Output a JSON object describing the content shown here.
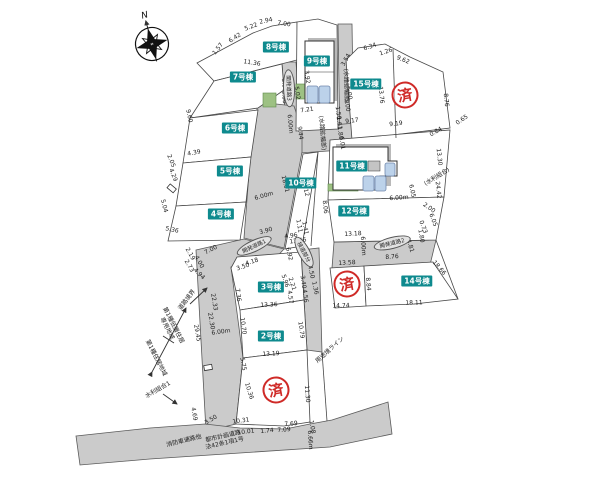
{
  "compass": {
    "label": "N"
  },
  "stamp_text": "済",
  "colors": {
    "badge": "#0e8a8e",
    "stamp": "#cf2a27",
    "road": "#cbcbcb",
    "parking": "#bcd2ea",
    "green": "#9dc183"
  },
  "badges": [
    {
      "t": "2号棟",
      "x": 271,
      "y": 336
    },
    {
      "t": "3号棟",
      "x": 271,
      "y": 287
    },
    {
      "t": "4号棟",
      "x": 221,
      "y": 214
    },
    {
      "t": "5号棟",
      "x": 230,
      "y": 171
    },
    {
      "t": "6号棟",
      "x": 235,
      "y": 128
    },
    {
      "t": "7号棟",
      "x": 243,
      "y": 77
    },
    {
      "t": "8号棟",
      "x": 276,
      "y": 47
    },
    {
      "t": "9号棟",
      "x": 317,
      "y": 61
    },
    {
      "t": "10号棟",
      "x": 301,
      "y": 183
    },
    {
      "t": "11号棟",
      "x": 352,
      "y": 166
    },
    {
      "t": "12号棟",
      "x": 354,
      "y": 211
    },
    {
      "t": "14号棟",
      "x": 417,
      "y": 281
    },
    {
      "t": "15号棟",
      "x": 366,
      "y": 84
    }
  ],
  "stamps": [
    {
      "x": 405,
      "y": 95
    },
    {
      "x": 347,
      "y": 284
    },
    {
      "x": 276,
      "y": 390
    }
  ],
  "ovals": [
    {
      "t": "開発道路3",
      "x": 289,
      "y": 88,
      "r": 88
    },
    {
      "t": "開発道路1",
      "x": 254,
      "y": 246,
      "r": -25
    },
    {
      "t": "接道部分",
      "x": 304,
      "y": 252,
      "r": 62
    },
    {
      "t": "開発道路2",
      "x": 392,
      "y": 243,
      "r": -14
    }
  ],
  "notes": [
    {
      "t": "(水路拡幅部)",
      "x": 346,
      "y": 86,
      "r": 88
    },
    {
      "t": "(水路拡幅部)",
      "x": 322,
      "y": 133,
      "r": 85
    },
    {
      "t": "用途境ライン",
      "x": 330,
      "y": 350,
      "r": -42
    },
    {
      "t": "道路境界",
      "x": 187,
      "y": 300,
      "r": -52
    },
    {
      "t": "第1種低層住居\n専用地域",
      "x": 170,
      "y": 327,
      "r": 63
    },
    {
      "t": "第1種住居地域",
      "x": 156,
      "y": 358,
      "r": 63
    },
    {
      "t": "水利組合1",
      "x": 158,
      "y": 390,
      "r": -30
    },
    {
      "t": "(水利組合)",
      "x": 437,
      "y": 177,
      "r": -32
    },
    {
      "t": "都市計画道路\n法42条1項1号",
      "x": 224,
      "y": 440,
      "r": -13
    },
    {
      "t": "消防車通路他",
      "x": 184,
      "y": 441,
      "r": -14
    }
  ],
  "dims": [
    {
      "t": "1.57",
      "x": 218,
      "y": 49,
      "r": -52
    },
    {
      "t": "6.42",
      "x": 235,
      "y": 38,
      "r": -33
    },
    {
      "t": "5.22",
      "x": 251,
      "y": 27,
      "r": -20
    },
    {
      "t": "2.94",
      "x": 266,
      "y": 21,
      "r": -12
    },
    {
      "t": "7.00",
      "x": 284,
      "y": 24,
      "r": 8
    },
    {
      "t": "11.36",
      "x": 252,
      "y": 63,
      "r": 9
    },
    {
      "t": "3.92",
      "x": 307,
      "y": 77,
      "r": 82
    },
    {
      "t": "5.02",
      "x": 297,
      "y": 93,
      "r": 82
    },
    {
      "t": "7.21",
      "x": 307,
      "y": 110,
      "r": -8
    },
    {
      "t": "9.44",
      "x": 300,
      "y": 133,
      "r": 82
    },
    {
      "t": "3.00",
      "x": 284,
      "y": 85,
      "r": 85
    },
    {
      "t": "5.00",
      "x": 284,
      "y": 97,
      "r": 85
    },
    {
      "t": "6.00m",
      "x": 290,
      "y": 124,
      "r": 85
    },
    {
      "t": "5.00",
      "x": 349,
      "y": 93,
      "r": 82
    },
    {
      "t": "3.00",
      "x": 347,
      "y": 105,
      "r": 82
    },
    {
      "t": "1.50",
      "x": 338,
      "y": 113,
      "r": 82
    },
    {
      "t": "1.61",
      "x": 339,
      "y": 123,
      "r": 82
    },
    {
      "t": "1.80",
      "x": 340,
      "y": 133,
      "r": 82
    },
    {
      "t": "6.01",
      "x": 342,
      "y": 143,
      "r": 82
    },
    {
      "t": "3.54",
      "x": 346,
      "y": 60,
      "r": -60
    },
    {
      "t": "6.34",
      "x": 370,
      "y": 47,
      "r": -18
    },
    {
      "t": "1.26",
      "x": 386,
      "y": 52,
      "r": -18
    },
    {
      "t": "9.62",
      "x": 403,
      "y": 60,
      "r": 22
    },
    {
      "t": "8.76",
      "x": 446,
      "y": 100,
      "r": 84
    },
    {
      "t": "13.76",
      "x": 381,
      "y": 95,
      "r": 84
    },
    {
      "t": "9.60",
      "x": 189,
      "y": 116,
      "r": 78
    },
    {
      "t": "4.39",
      "x": 194,
      "y": 153,
      "r": -10
    },
    {
      "t": "2.05",
      "x": 171,
      "y": 161,
      "r": 68
    },
    {
      "t": "4.29",
      "x": 173,
      "y": 175,
      "r": 68
    },
    {
      "t": "5.04",
      "x": 164,
      "y": 206,
      "r": 75
    },
    {
      "t": "5.36",
      "x": 172,
      "y": 230,
      "r": 12
    },
    {
      "t": "6.00m",
      "x": 264,
      "y": 196,
      "r": -16
    },
    {
      "t": "3.90",
      "x": 266,
      "y": 231,
      "r": -16
    },
    {
      "t": "18.01",
      "x": 285,
      "y": 184,
      "r": 76
    },
    {
      "t": "17.12",
      "x": 305,
      "y": 188,
      "r": 76
    },
    {
      "t": "9.17",
      "x": 352,
      "y": 121,
      "r": -7
    },
    {
      "t": "9.19",
      "x": 396,
      "y": 124,
      "r": -7
    },
    {
      "t": "0.84",
      "x": 436,
      "y": 132,
      "r": -30
    },
    {
      "t": "0.65",
      "x": 462,
      "y": 120,
      "r": -35
    },
    {
      "t": "13.30",
      "x": 439,
      "y": 157,
      "r": 84
    },
    {
      "t": "24.42",
      "x": 438,
      "y": 190,
      "r": 84
    },
    {
      "t": "6.00m",
      "x": 399,
      "y": 198,
      "r": -4
    },
    {
      "t": "6.05",
      "x": 412,
      "y": 191,
      "r": 78
    },
    {
      "t": "2.00",
      "x": 429,
      "y": 208,
      "r": 35
    },
    {
      "t": "6.05",
      "x": 433,
      "y": 220,
      "r": 70
    },
    {
      "t": "0.73",
      "x": 423,
      "y": 227,
      "r": 70
    },
    {
      "t": "8.06",
      "x": 325,
      "y": 207,
      "r": 84
    },
    {
      "t": "13.18",
      "x": 353,
      "y": 234,
      "r": -3
    },
    {
      "t": "1.11",
      "x": 299,
      "y": 226,
      "r": 80
    },
    {
      "t": "1.41",
      "x": 305,
      "y": 228,
      "r": 80
    },
    {
      "t": "4.96",
      "x": 291,
      "y": 236,
      "r": -8
    },
    {
      "t": "13.46",
      "x": 298,
      "y": 241,
      "r": -8
    },
    {
      "t": "6.92",
      "x": 289,
      "y": 254,
      "r": 76
    },
    {
      "t": "5.96",
      "x": 285,
      "y": 281,
      "r": 72
    },
    {
      "t": "2.21",
      "x": 292,
      "y": 284,
      "r": 72
    },
    {
      "t": "13.58",
      "x": 347,
      "y": 263,
      "r": -3
    },
    {
      "t": "8.84",
      "x": 368,
      "y": 284,
      "r": 86
    },
    {
      "t": "8.76",
      "x": 392,
      "y": 257,
      "r": -4
    },
    {
      "t": "4.81",
      "x": 410,
      "y": 246,
      "r": 72
    },
    {
      "t": "6.00m",
      "x": 363,
      "y": 246,
      "r": 86
    },
    {
      "t": "1.80",
      "x": 421,
      "y": 236,
      "r": 80
    },
    {
      "t": "18.66",
      "x": 439,
      "y": 268,
      "r": 49
    },
    {
      "t": "14.74",
      "x": 341,
      "y": 306,
      "r": -2
    },
    {
      "t": "18.11",
      "x": 414,
      "y": 303,
      "r": -2
    },
    {
      "t": "1.67",
      "x": 305,
      "y": 257,
      "r": 62
    },
    {
      "t": "4.50",
      "x": 311,
      "y": 272,
      "r": 78
    },
    {
      "t": "1.36",
      "x": 315,
      "y": 288,
      "r": 78
    },
    {
      "t": "3.40",
      "x": 303,
      "y": 282,
      "r": 82
    },
    {
      "t": "4.56",
      "x": 305,
      "y": 296,
      "r": 82
    },
    {
      "t": "4.18",
      "x": 252,
      "y": 262,
      "r": -18
    },
    {
      "t": "3.50",
      "x": 243,
      "y": 267,
      "r": -18
    },
    {
      "t": "7.36",
      "x": 238,
      "y": 295,
      "r": 82
    },
    {
      "t": "13.36",
      "x": 269,
      "y": 305,
      "r": -3
    },
    {
      "t": "4.57",
      "x": 290,
      "y": 297,
      "r": 82
    },
    {
      "t": "2.19",
      "x": 190,
      "y": 254,
      "r": 60
    },
    {
      "t": "4.00",
      "x": 199,
      "y": 262,
      "r": 60
    },
    {
      "t": "2.73",
      "x": 189,
      "y": 266,
      "r": 60
    },
    {
      "t": "4.94",
      "x": 199,
      "y": 274,
      "r": 45
    },
    {
      "t": "7.00",
      "x": 211,
      "y": 250,
      "r": -28
    },
    {
      "t": "22.33",
      "x": 214,
      "y": 302,
      "r": 80
    },
    {
      "t": "22.30",
      "x": 211,
      "y": 321,
      "r": 80
    },
    {
      "t": "29.45",
      "x": 197,
      "y": 333,
      "r": 80
    },
    {
      "t": "6.00m",
      "x": 221,
      "y": 332,
      "r": -8
    },
    {
      "t": "10.70",
      "x": 243,
      "y": 326,
      "r": 82
    },
    {
      "t": "10.79",
      "x": 301,
      "y": 330,
      "r": 82
    },
    {
      "t": "13.19",
      "x": 271,
      "y": 354,
      "r": -3
    },
    {
      "t": "5.75",
      "x": 243,
      "y": 364,
      "r": 80
    },
    {
      "t": "10.36",
      "x": 249,
      "y": 391,
      "r": 73
    },
    {
      "t": "11.30",
      "x": 307,
      "y": 394,
      "r": 86
    },
    {
      "t": "10.31",
      "x": 241,
      "y": 421,
      "r": -8
    },
    {
      "t": "10.01",
      "x": 246,
      "y": 432,
      "r": -7
    },
    {
      "t": "1.74",
      "x": 267,
      "y": 431,
      "r": -5
    },
    {
      "t": "7.09",
      "x": 284,
      "y": 430,
      "r": -4
    },
    {
      "t": "7.69",
      "x": 291,
      "y": 424,
      "r": -4
    },
    {
      "t": "1.08",
      "x": 312,
      "y": 427,
      "r": 80
    },
    {
      "t": "6.66m",
      "x": 310,
      "y": 440,
      "r": 86
    },
    {
      "t": "4.69",
      "x": 194,
      "y": 414,
      "r": 80
    },
    {
      "t": "3.50",
      "x": 211,
      "y": 420,
      "r": -32
    }
  ]
}
